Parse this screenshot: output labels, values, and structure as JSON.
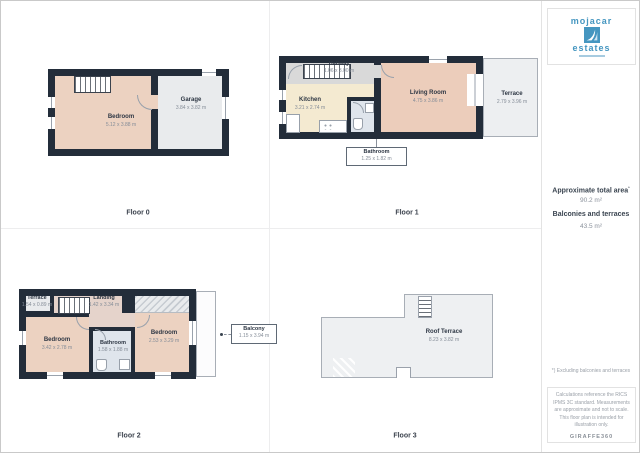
{
  "branding": {
    "logo_line1": "mojacar",
    "logo_line2": "estates",
    "brand_icon": "sail-wave-icon",
    "footer_logo": "GIRAFFE360"
  },
  "summary": {
    "total_area_label": "Approximate total area",
    "total_area_sup": "*",
    "total_area_value": "90.2 m²",
    "balconies_label": "Balconies and terraces",
    "balconies_value": "43.5 m²",
    "footnote": "*) Excluding balconies and terraces",
    "disclaimer": "Calculations reference the RICS IPMS 3C standard. Measurements are approximate and not to scale. This floor plan is intended for illustration only."
  },
  "floors": {
    "floor0": {
      "label": "Floor 0",
      "bedroom": {
        "name": "Bedroom",
        "dims": "5.12 x 3.88 m"
      },
      "garage": {
        "name": "Garage",
        "dims": "3.84 x 3.82 m"
      }
    },
    "floor1": {
      "label": "Floor 1",
      "hallway": {
        "name": "Hallway",
        "dims": "1.06 x 3.00 m"
      },
      "kitchen": {
        "name": "Kitchen",
        "dims": "3.21 x 2.74 m"
      },
      "living_room": {
        "name": "Living Room",
        "dims": "4.75 x 3.86 m"
      },
      "terrace": {
        "name": "Terrace",
        "dims": "2.79 x 3.96 m"
      },
      "bathroom": {
        "name": "Bathroom",
        "dims": "1.25 x 1.82 m"
      }
    },
    "floor2": {
      "label": "Floor 2",
      "terrace": {
        "name": "Terrace",
        "dims": "1.54 x 0.89 m"
      },
      "landing": {
        "name": "Landing",
        "dims": "1.42 x 3.34 m"
      },
      "bedroom_left": {
        "name": "Bedroom",
        "dims": "3.42 x 2.78 m"
      },
      "bathroom": {
        "name": "Bathroom",
        "dims": "1.58 x 1.88 m"
      },
      "bedroom_right": {
        "name": "Bedroom",
        "dims": "2.53 x 3.29 m"
      },
      "balcony": {
        "name": "Balcony",
        "dims": "1.15 x 3.94 m"
      }
    },
    "floor3": {
      "label": "Floor 3",
      "roof_terrace": {
        "name": "Roof Terrace",
        "dims": "8.23 x 3.82 m"
      }
    }
  },
  "colors": {
    "wall": "#232d3a",
    "bedroom_fill": "#ecd2c1",
    "living_fill": "#eccdbb",
    "kitchen_fill": "#f4ead1",
    "bathroom_fill": "#dfe5ec",
    "terrace_fill": "#edeff1",
    "hallway_fill": "#d9d9d9",
    "landing_fill": "#e5d3cb",
    "brand_blue": "#4596c0"
  }
}
